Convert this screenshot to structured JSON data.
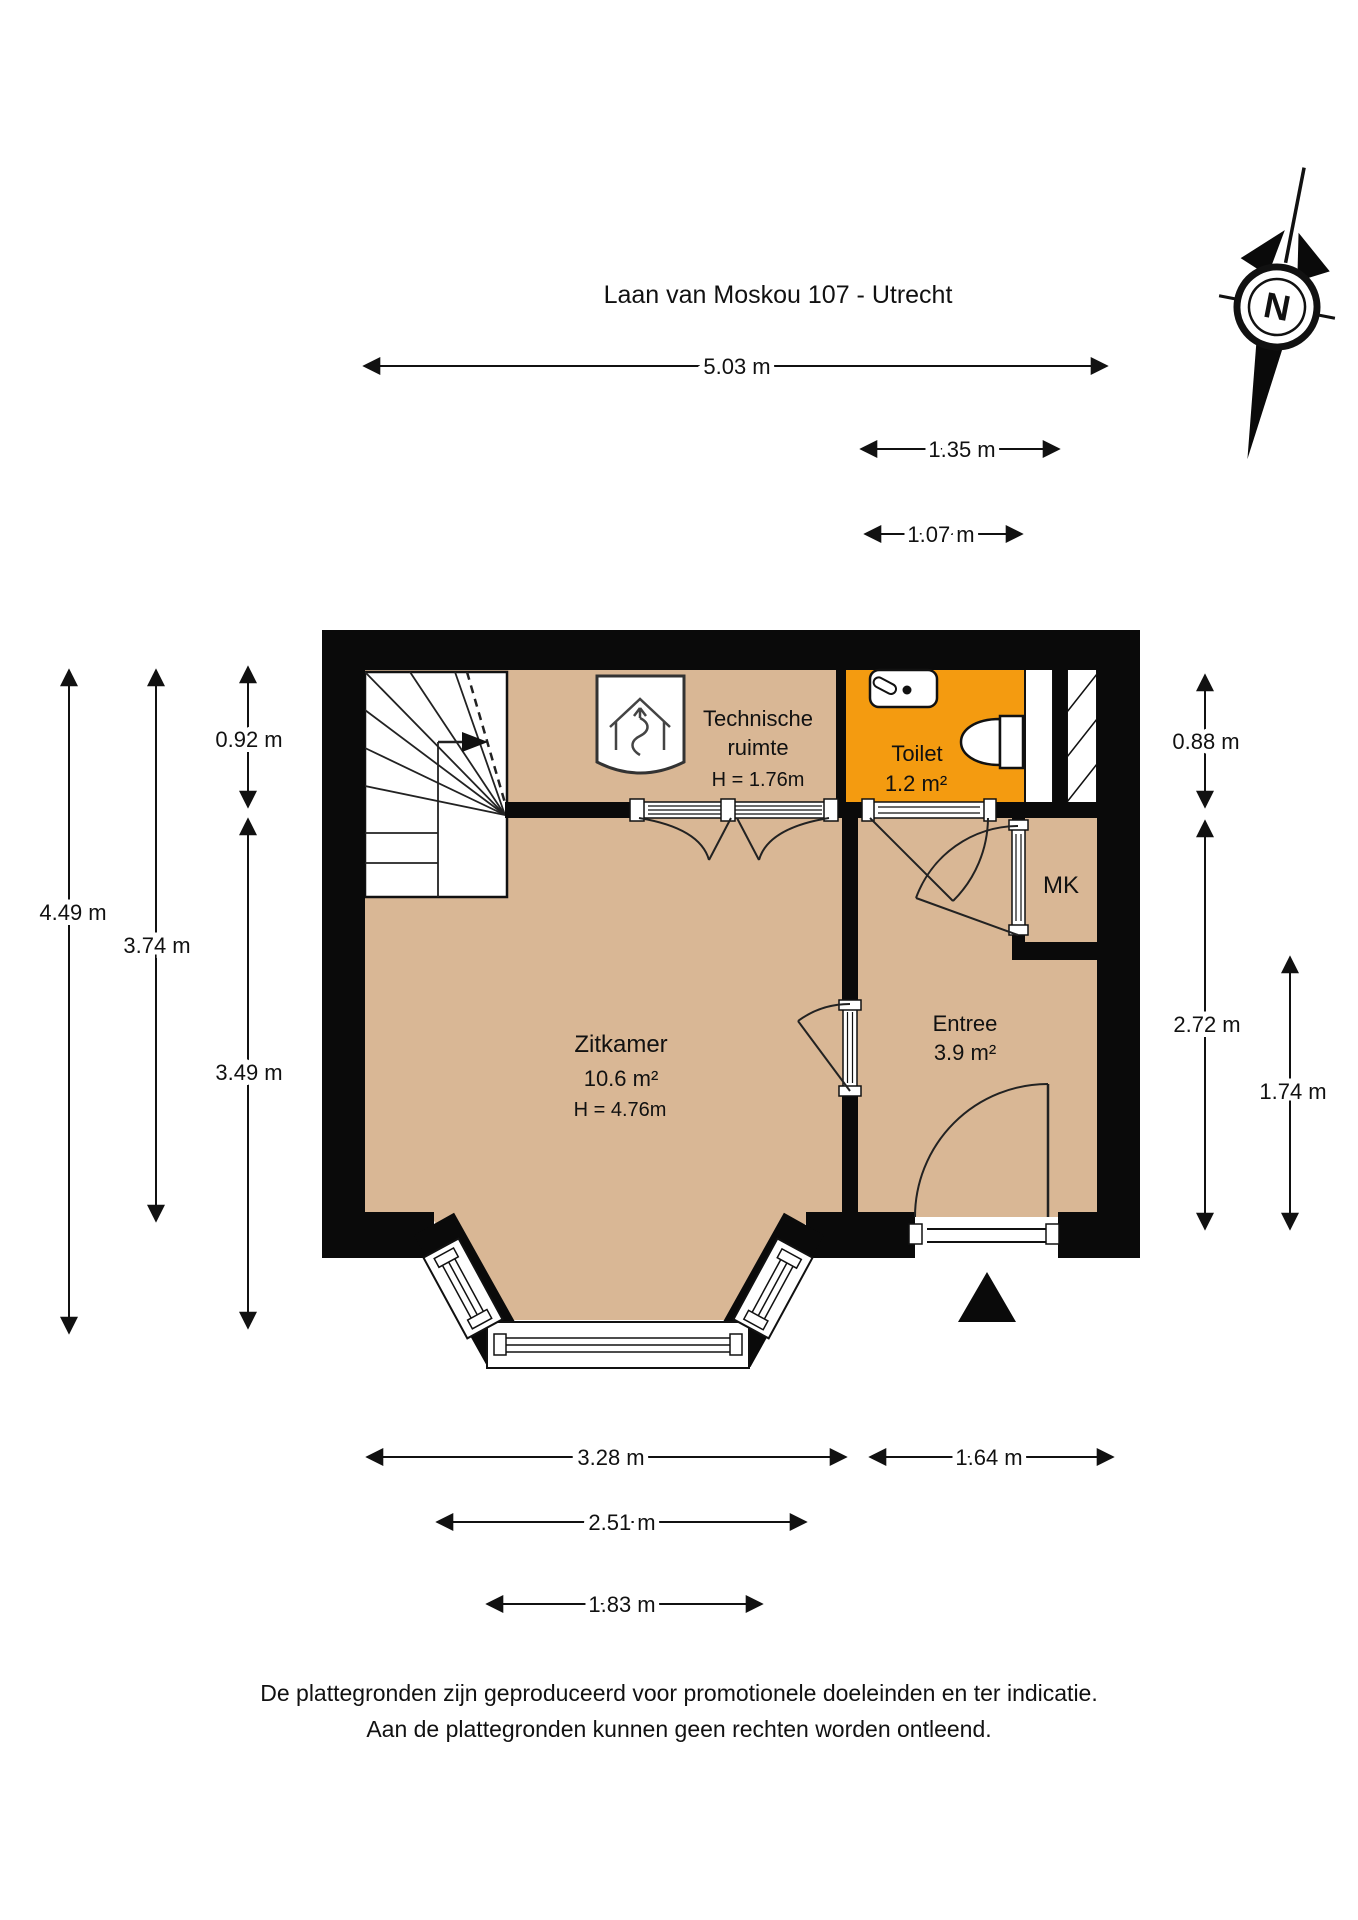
{
  "title": "Laan van Moskou 107 - Utrecht",
  "compass": {
    "label": "N"
  },
  "rooms": {
    "technische_ruimte": {
      "name_line1": "Technische",
      "name_line2": "ruimte",
      "height": "H = 1.76m"
    },
    "toilet": {
      "name": "Toilet",
      "area": "1.2 m²"
    },
    "mk": {
      "name": "MK"
    },
    "zitkamer": {
      "name": "Zitkamer",
      "area": "10.6 m²",
      "height": "H = 4.76m"
    },
    "entree": {
      "name": "Entree",
      "area": "3.9 m²"
    }
  },
  "dimensions": {
    "top": {
      "d1": "5.03 m",
      "d2": "1.35 m",
      "d3": "1.07 m"
    },
    "left": {
      "d1": "4.49 m",
      "d2": "3.74 m",
      "d3": "0.92 m",
      "d4": "3.49 m"
    },
    "right": {
      "d1": "0.88 m",
      "d2": "2.72 m",
      "d3": "1.74 m"
    },
    "bottom": {
      "d1": "3.28 m",
      "d2": "1.64 m",
      "d3": "2.51 m",
      "d4": "1.83 m"
    }
  },
  "footer": {
    "line1": "De plattegronden zijn geproduceerd voor promotionele doeleinden en ter indicatie.",
    "line2": "Aan de plattegronden kunnen geen rechten worden ontleend."
  },
  "colors": {
    "floor": "#d9b795",
    "toilet_floor": "#f49b10",
    "wall": "#0a0a0a"
  }
}
